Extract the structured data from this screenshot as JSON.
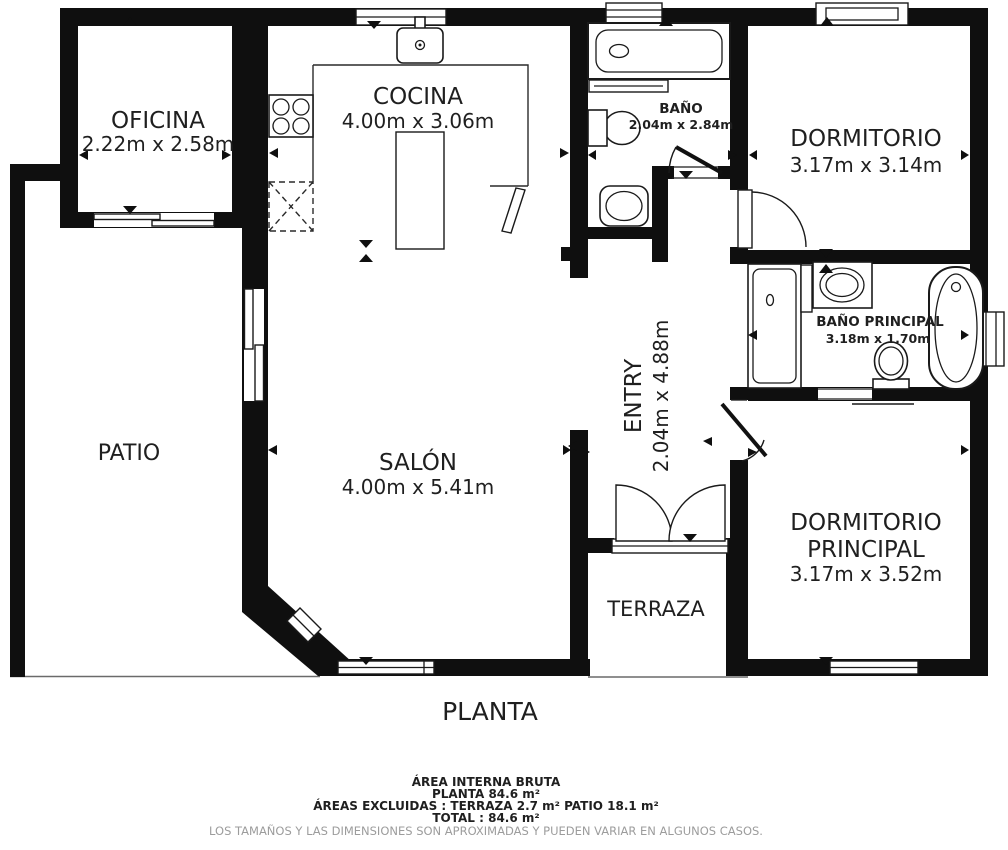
{
  "floor_plan": {
    "title": "PLANTA",
    "rooms": {
      "oficina": {
        "name": "OFICINA",
        "dims": "2.22m x 2.58m"
      },
      "cocina": {
        "name": "COCINA",
        "dims": "4.00m x 3.06m"
      },
      "bano": {
        "name": "BAÑO",
        "dims": "2.04m x 2.84m"
      },
      "dormitorio": {
        "name": "DORMITORIO",
        "dims": "3.17m x 3.14m"
      },
      "patio": {
        "name": "PATIO"
      },
      "salon": {
        "name": "SALÓN",
        "dims": "4.00m x 5.41m"
      },
      "entry": {
        "name": "ENTRY",
        "dims": "2.04m x 4.88m"
      },
      "bano_principal": {
        "name": "BAÑO PRINCIPAL",
        "dims": "3.18m x 1.70m"
      },
      "dormitorio_principal": {
        "line1": "DORMITORIO",
        "line2": "PRINCIPAL",
        "dims": "3.17m x 3.52m"
      },
      "terraza": {
        "name": "TERRAZA"
      }
    },
    "summary": {
      "area_heading": "ÁREA INTERNA BRUTA",
      "planta_area": "PLANTA 84.6 m²",
      "excluded": "ÁREAS EXCLUIDAS :  TERRAZA 2.7 m²   PATIO 18.1 m²",
      "total": "TOTAL :  84.6 m²",
      "disclaimer": "LOS TAMAÑOS Y LAS DIMENSIONES SON APROXIMADAS Y PUEDEN VARIAR EN ALGUNOS CASOS."
    },
    "colors": {
      "wall": "#0f0f0f",
      "floor": "#ffffff",
      "label": "#1f1f1f",
      "disclaimer_text": "#9c9c9c"
    }
  }
}
